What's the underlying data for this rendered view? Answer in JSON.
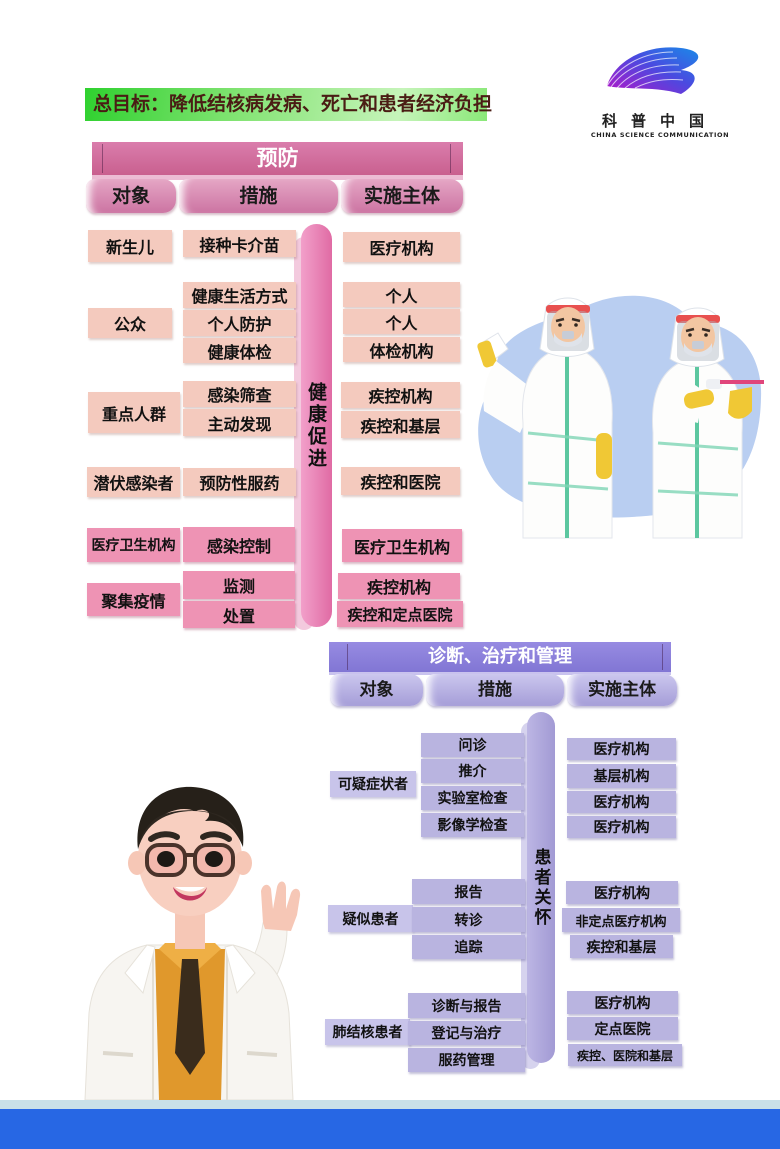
{
  "banner": {
    "text": "总目标：降低结核病发病、死亡和患者经济负担"
  },
  "logo": {
    "cn": "科普中国",
    "en": "CHINA SCIENCE COMMUNICATION"
  },
  "colors": {
    "banner_green": "#2fd12f",
    "prevention_pink": "#cc6f9e",
    "cell_light_pink": "#f4cabe",
    "cell_dark_pink": "#ee93b4",
    "diagnosis_purple": "#8b80db",
    "cell_purple": "#b9b4e0",
    "footer_blue": "#2767e4"
  },
  "prevention": {
    "title": "预防",
    "columns": [
      "对象",
      "措施",
      "实施主体"
    ],
    "side_label": "健康促进",
    "objects": [
      "新生儿",
      "公众",
      "重点人群",
      "潜伏感染者",
      "医疗卫生机构",
      "聚集疫情"
    ],
    "measures": [
      "接种卡介苗",
      "健康生活方式",
      "个人防护",
      "健康体检",
      "感染筛查",
      "主动发现",
      "预防性服药",
      "感染控制",
      "监测",
      "处置"
    ],
    "subjects": [
      "医疗机构",
      "个人",
      "个人",
      "体检机构",
      "疾控机构",
      "疾控和基层",
      "疾控和医院",
      "医疗卫生机构",
      "疾控机构",
      "疾控和定点医院"
    ]
  },
  "diagnosis": {
    "title": "诊断、治疗和管理",
    "columns": [
      "对象",
      "措施",
      "实施主体"
    ],
    "side_label": "患者关怀",
    "objects": [
      "可疑症状者",
      "疑似患者",
      "肺结核患者"
    ],
    "measures": [
      "问诊",
      "推介",
      "实验室检查",
      "影像学检查",
      "报告",
      "转诊",
      "追踪",
      "诊断与报告",
      "登记与治疗",
      "服药管理"
    ],
    "subjects": [
      "医疗机构",
      "基层机构",
      "医疗机构",
      "医疗机构",
      "医疗机构",
      "非定点医疗机构",
      "疾控和基层",
      "医疗机构",
      "定点医院",
      "疾控、医院和基层"
    ]
  }
}
